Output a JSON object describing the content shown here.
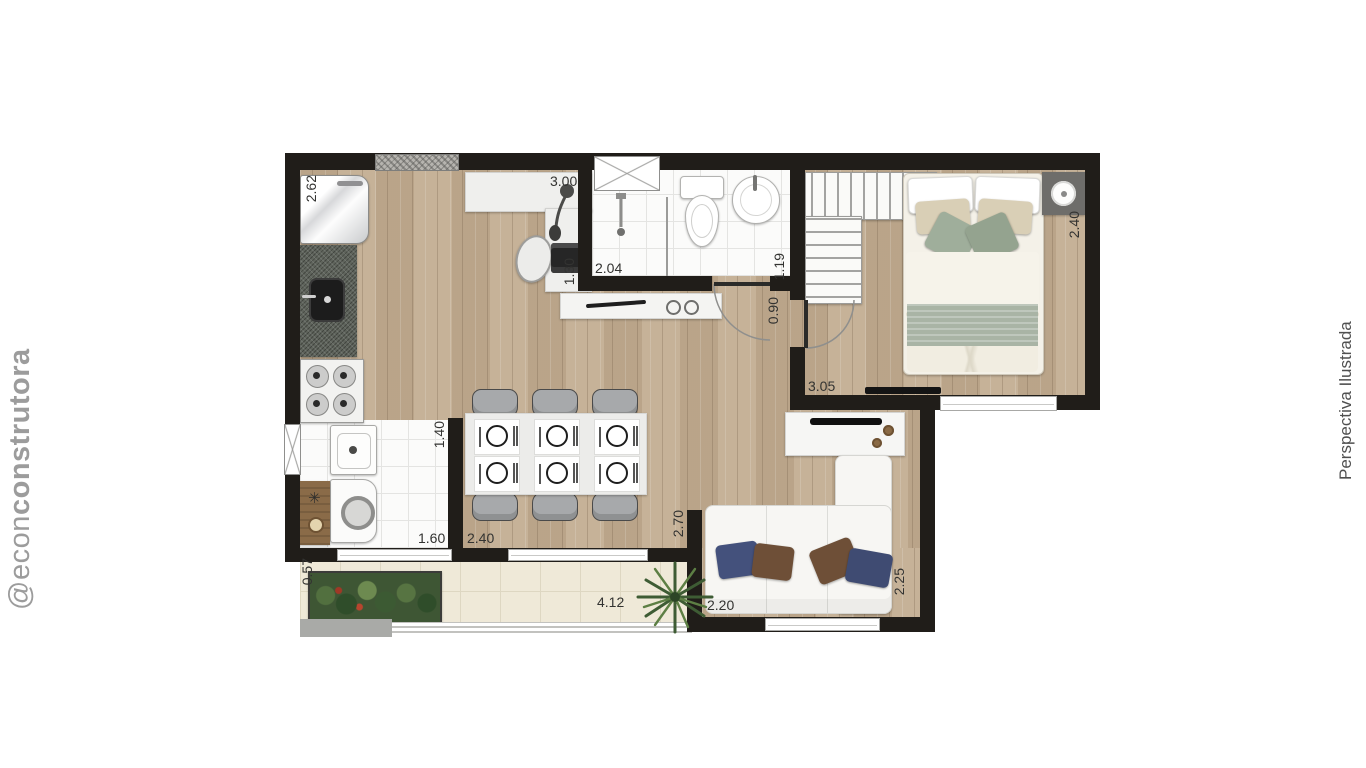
{
  "branding": {
    "watermark_prefix": "@econ",
    "watermark_suffix": "construtora",
    "caption": "Perspectiva Ilustrada"
  },
  "plan": {
    "labels": {
      "kitchen_depth": "2.62",
      "office_width": "3.00",
      "office_depth": "1.30",
      "shower_width": "2.04",
      "bathroom_depth": "1.19",
      "hall_width": "0.90",
      "bedroom_width": "3.05",
      "bedroom_depth": "2.40",
      "service_depth": "1.40",
      "service_width": "1.60",
      "dining_width": "2.40",
      "living_wall": "2.70",
      "sofa_span": "2.20",
      "living_side": "2.25",
      "balcony_span": "4.12",
      "planter_depth": "0.57"
    },
    "colors": {
      "wall": "#201d19",
      "wood_floor": "#c2ad92",
      "wet_tile": "#fbfbfa",
      "balcony_tile": "#efe9d8",
      "sage_accent": "#a9b4a5",
      "blue_pillow": "#44517c",
      "brown_pillow": "#6e4f37",
      "label_text": "#333331",
      "watermark_gray": "#9c9c9c"
    }
  }
}
